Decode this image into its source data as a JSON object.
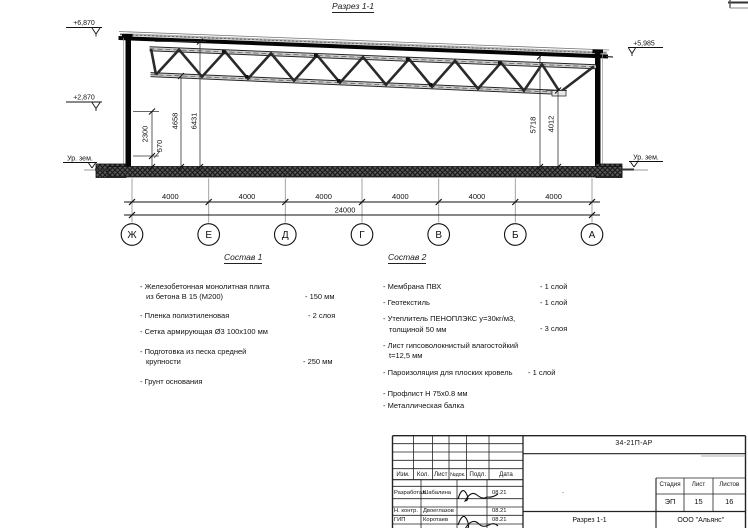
{
  "section": {
    "title": "Разрез 1-1",
    "elev_top_left": "+6,870",
    "elev_mid_left": "+2,870",
    "elev_top_right": "+5,985",
    "ground_left": "Ур. зем.",
    "ground_right": "Ур. зем.",
    "dim_2300": "2300",
    "dim_570": "570",
    "dim_4658": "4658",
    "dim_6431": "6431",
    "dim_5718": "5718",
    "dim_4012": "4012",
    "bay_dims": [
      "4000",
      "4000",
      "4000",
      "4000",
      "4000",
      "4000"
    ],
    "total_dim": "24000",
    "axes": [
      "Ж",
      "Е",
      "Д",
      "Г",
      "В",
      "Б",
      "А"
    ]
  },
  "sostav1": {
    "title": "Состав 1",
    "items": [
      {
        "line1": "- Железобетонная  монолитная плита",
        "line2": "из бетона В 15 (М200)",
        "value": "- 150 мм"
      },
      {
        "line1": "- Пленка полиэтиленовая",
        "line2": "",
        "value": "- 2 слоя"
      },
      {
        "line1": "- Сетка армирующая Ø3 100х100 мм",
        "line2": "",
        "value": ""
      },
      {
        "line1": "- Подготовка из песка средней",
        "line2": "крупности",
        "value": "- 250 мм"
      },
      {
        "line1": "- Грунт основания",
        "line2": "",
        "value": ""
      }
    ]
  },
  "sostav2": {
    "title": "Состав 2",
    "items": [
      {
        "line1": "- Мембрана ПВХ",
        "line2": "",
        "value": "- 1 слой"
      },
      {
        "line1": "- Геотекстиль",
        "line2": "",
        "value": "- 1 слой"
      },
      {
        "line1": "- Утеплитель ПЕНОПЛЭКС у=30кг/м3,",
        "line2": "толщиной 50 мм",
        "value": "- 3 слоя"
      },
      {
        "line1": "- Лист гипсоволокнистый влагостойкий",
        "line2": "t=12,5 мм",
        "value": ""
      },
      {
        "line1": "- Пароизоляция для плоских кровель",
        "line2": "",
        "value": "- 1 слой"
      },
      {
        "line1": "- Профлист Н 75х0.8 мм",
        "line2": "",
        "value": ""
      },
      {
        "line1": "- Металлическая балка",
        "line2": "",
        "value": ""
      }
    ]
  },
  "titleblock": {
    "doc_number": "34-21П-АР",
    "col_izm": "Изм.",
    "col_kol": "Кол.",
    "col_list": "Лист",
    "col_ndok": "№док.",
    "col_podl": "Подл.",
    "col_data": "Дата",
    "rows": [
      {
        "role": "Разработал",
        "name": "Шабалина",
        "date": "08.21"
      },
      {
        "role": "Н. контр.",
        "name": "Двоеглазов",
        "date": "08.21"
      },
      {
        "role": "ГИП",
        "name": "Коротаев",
        "date": "08.21"
      }
    ],
    "mark": ".",
    "stage_label": "Стадия",
    "sheet_label": "Лист",
    "sheets_label": "Листов",
    "stage": "ЭП",
    "sheet_num": "15",
    "sheets_total": "16",
    "drawing_name": "Разрез 1-1",
    "company": "ООО \"Альянс\""
  }
}
